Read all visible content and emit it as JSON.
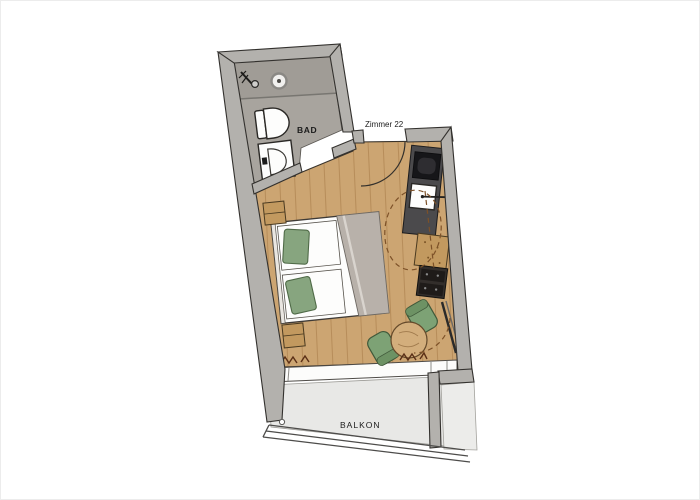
{
  "labels": {
    "bathroom": "BAD",
    "room": "Zimmer 22",
    "balcony": "BALKON"
  },
  "rooms": [
    {
      "name": "bathroom",
      "label": "BAD",
      "fixtures": [
        "shower",
        "floor-drain",
        "glass-partition",
        "toilet",
        "washbasin"
      ]
    },
    {
      "name": "bedroom",
      "label": "Zimmer 22",
      "furniture": [
        "entrance-door",
        "kitchenette",
        "kitchen-sink",
        "kitchen-appliance",
        "desk",
        "drawer-unit",
        "double-bed",
        "two-pillows",
        "two-nightstands",
        "round-table",
        "two-armchairs",
        "radiator-symbols",
        "balcony-window"
      ]
    },
    {
      "name": "balcony",
      "label": "BALKON",
      "features": [
        "railing",
        "pillar",
        "neighbor-terrace"
      ]
    }
  ],
  "colors": {
    "wall": "#b3b1ad",
    "wall_outline": "#33312e",
    "bath_floor": "#a8a49e",
    "shower_floor": "#a09c96",
    "wood_floor": "#cca572",
    "wood_grain": "#8c5e2d",
    "balcony_floor": "#e8e8e6",
    "neighbor_floor": "#ececea",
    "window_white": "#fcfcfb",
    "counter": "#4b4a4c",
    "appliance": "#161619",
    "furniture_wood": "#c2995f",
    "drawer": "#332e2b",
    "drawer_face": "#1f1b19",
    "bed": "#fdfdfc",
    "blanket": "#b8b1aa",
    "blanket_fold": "#d9d4ce",
    "pillow": "#87a57f",
    "pillow_edge": "#4f6a47",
    "chair": "#7da275",
    "chair_edge": "#40593a",
    "chair_back": "#6d9264",
    "table": "#d3ae7c",
    "table_edge": "#64492a",
    "dash": "#7d5128",
    "line": "#33302c",
    "railing": "#4d4c4a",
    "label": "#1b1b1b"
  }
}
